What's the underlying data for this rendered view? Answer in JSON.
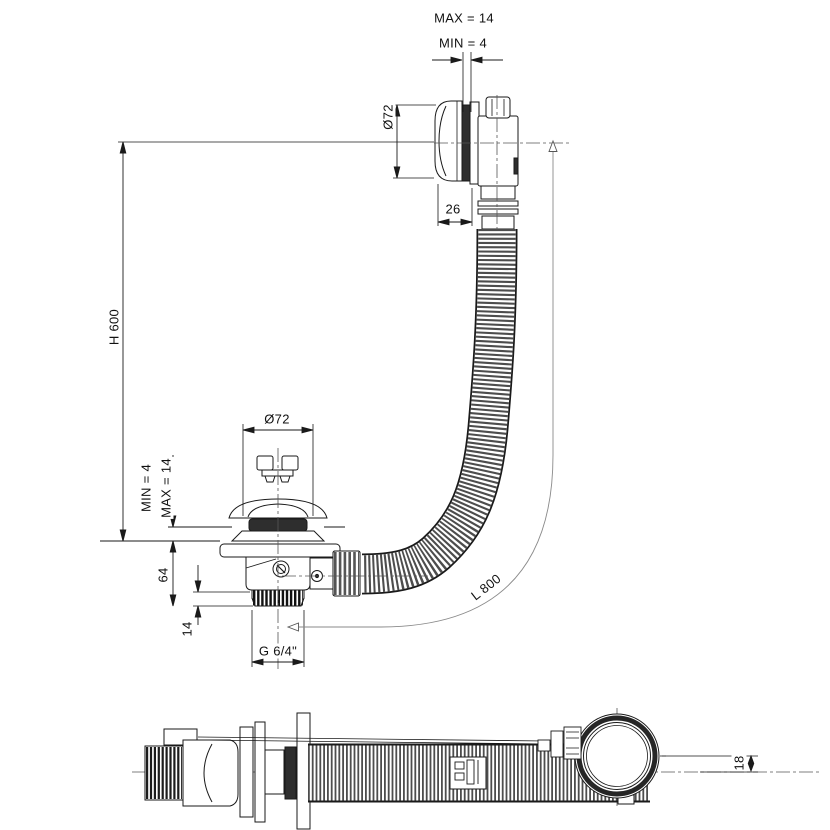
{
  "colors": {
    "line": "#1a1a1a",
    "dark_fill": "#2e2e2e",
    "hose_rib": "#4d4d4d",
    "background": "#ffffff"
  },
  "front_view": {
    "overflow_dims": {
      "wall_max": "MAX = 14",
      "wall_min": "MIN = 4",
      "cap_diameter": "Ø72",
      "cap_depth": "26"
    },
    "install_height": "H 600",
    "drain_dims": {
      "cap_diameter": "Ø72",
      "floor_min": "MIN = 4",
      "floor_max": "MAX = 14",
      "body_height": "64",
      "thread_length": "14",
      "thread_size": "G 6/4\"",
      "hose_length": "L 800"
    }
  },
  "bottom_view": {
    "head_offset": "18"
  }
}
